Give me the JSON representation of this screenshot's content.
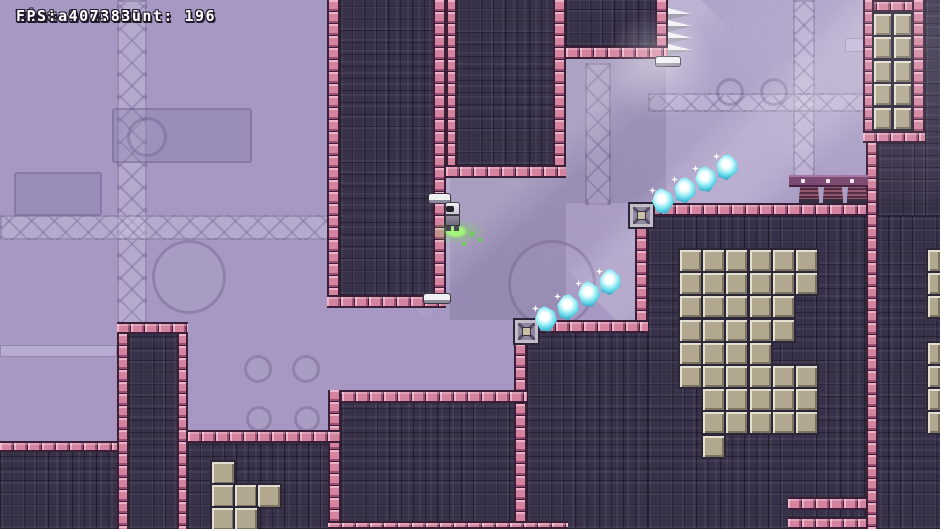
{
  "hud": {
    "lines": [
      "Time 0:16.19",
      "Best 0:13.72",
      "Instance count: 196",
      "FPS: 407.83"
    ]
  },
  "colors": {
    "bg": "#a698c2",
    "dark": "#38314a",
    "pink": "#d4849f",
    "pinkLight": "#eeb3c9",
    "pinkDark": "#9c4f72",
    "tan": "#b2a78f",
    "tanLight": "#e3dfd0",
    "tanDark": "#7b7261",
    "gem": "#6adcec",
    "green": "#5fd944",
    "beam": "#7a4870"
  },
  "level": {
    "decor": [
      {
        "t": "truss",
        "x": 117,
        "y": 0,
        "w": 30,
        "h": 325
      },
      {
        "t": "truss",
        "x": 793,
        "y": 0,
        "w": 22,
        "h": 178
      },
      {
        "t": "truss",
        "x": 0,
        "y": 215,
        "w": 335,
        "h": 25
      },
      {
        "t": "truss",
        "x": 648,
        "y": 93,
        "w": 222,
        "h": 19
      },
      {
        "t": "truss",
        "x": 585,
        "y": 63,
        "w": 26,
        "h": 142
      },
      {
        "t": "shade",
        "x": 450,
        "y": 178,
        "w": 116,
        "h": 142
      },
      {
        "t": "shade",
        "x": 566,
        "y": 59,
        "w": 100,
        "h": 144
      },
      {
        "t": "panel",
        "x": 14,
        "y": 172,
        "w": 88,
        "h": 44
      },
      {
        "t": "panel",
        "x": 112,
        "y": 108,
        "w": 140,
        "h": 55
      },
      {
        "t": "panel",
        "x": 258,
        "y": 448,
        "w": 72,
        "h": 81
      },
      {
        "t": "circle",
        "x": 127,
        "y": 117,
        "w": 40,
        "h": 40
      },
      {
        "t": "circle",
        "x": 152,
        "y": 240,
        "w": 74,
        "h": 74
      },
      {
        "t": "circle",
        "x": 244,
        "y": 355,
        "w": 28,
        "h": 28
      },
      {
        "t": "circle",
        "x": 292,
        "y": 355,
        "w": 28,
        "h": 28
      },
      {
        "t": "circle",
        "x": 246,
        "y": 406,
        "w": 26,
        "h": 26
      },
      {
        "t": "circle",
        "x": 294,
        "y": 406,
        "w": 26,
        "h": 26
      },
      {
        "t": "circle",
        "x": 716,
        "y": 78,
        "w": 28,
        "h": 28
      },
      {
        "t": "circle",
        "x": 760,
        "y": 78,
        "w": 28,
        "h": 28
      },
      {
        "t": "circle",
        "x": 508,
        "y": 240,
        "w": 88,
        "h": 88
      },
      {
        "t": "pipe",
        "x": 845,
        "y": 38,
        "w": 21,
        "h": 14
      },
      {
        "t": "pipe",
        "x": 0,
        "y": 345,
        "w": 117,
        "h": 12
      },
      {
        "t": "ray",
        "x": 470,
        "y": -80,
        "w": 130,
        "h": 420,
        "r": 46
      },
      {
        "t": "ray",
        "x": 700,
        "y": -60,
        "w": 110,
        "h": 430,
        "r": 46
      }
    ],
    "fills": [
      {
        "name": "column-a",
        "x": 340,
        "y": 0,
        "w": 93,
        "h": 295
      },
      {
        "name": "column-b",
        "x": 457,
        "y": 0,
        "w": 96,
        "h": 165
      },
      {
        "name": "column-c",
        "x": 566,
        "y": 0,
        "w": 89,
        "h": 46
      },
      {
        "name": "right-wall-top",
        "x": 925,
        "y": 0,
        "w": 15,
        "h": 216
      },
      {
        "name": "under-frame",
        "x": 878,
        "y": 143,
        "w": 47,
        "h": 73
      },
      {
        "name": "right-mass",
        "x": 648,
        "y": 216,
        "w": 292,
        "h": 313
      },
      {
        "name": "mid-step",
        "x": 527,
        "y": 333,
        "w": 121,
        "h": 196
      },
      {
        "name": "bottom-middle",
        "x": 341,
        "y": 403,
        "w": 173,
        "h": 126
      },
      {
        "name": "bottom-strip-right",
        "x": 188,
        "y": 443,
        "w": 152,
        "h": 86
      },
      {
        "name": "bottom-strip-left",
        "x": 0,
        "y": 452,
        "w": 117,
        "h": 77
      },
      {
        "name": "column-d",
        "x": 129,
        "y": 334,
        "w": 48,
        "h": 195
      }
    ],
    "pink_bars": [
      {
        "x": 327,
        "y": 0,
        "w": 13,
        "h": 308,
        "dir": "v"
      },
      {
        "x": 433,
        "y": 0,
        "w": 13,
        "h": 295,
        "dir": "v"
      },
      {
        "x": 327,
        "y": 295,
        "w": 119,
        "h": 13,
        "dir": "h"
      },
      {
        "x": 446,
        "y": 0,
        "w": 11,
        "h": 165,
        "dir": "v"
      },
      {
        "x": 553,
        "y": 0,
        "w": 13,
        "h": 165,
        "dir": "v"
      },
      {
        "x": 446,
        "y": 165,
        "w": 120,
        "h": 13,
        "dir": "h"
      },
      {
        "x": 655,
        "y": 0,
        "w": 13,
        "h": 46,
        "dir": "v"
      },
      {
        "x": 566,
        "y": 46,
        "w": 102,
        "h": 13,
        "dir": "h"
      },
      {
        "x": 648,
        "y": 203,
        "w": 219,
        "h": 13,
        "dir": "h"
      },
      {
        "x": 635,
        "y": 203,
        "w": 13,
        "h": 130,
        "dir": "v"
      },
      {
        "x": 514,
        "y": 320,
        "w": 134,
        "h": 13,
        "dir": "h"
      },
      {
        "x": 514,
        "y": 320,
        "w": 13,
        "h": 209,
        "dir": "v"
      },
      {
        "x": 328,
        "y": 390,
        "w": 199,
        "h": 13,
        "dir": "h"
      },
      {
        "x": 328,
        "y": 390,
        "w": 13,
        "h": 139,
        "dir": "v"
      },
      {
        "x": 328,
        "y": 521,
        "w": 240,
        "h": 8,
        "dir": "h"
      },
      {
        "x": 188,
        "y": 430,
        "w": 152,
        "h": 13,
        "dir": "h"
      },
      {
        "x": 0,
        "y": 441,
        "w": 117,
        "h": 11,
        "dir": "h"
      },
      {
        "x": 117,
        "y": 322,
        "w": 12,
        "h": 207,
        "dir": "v"
      },
      {
        "x": 177,
        "y": 322,
        "w": 11,
        "h": 207,
        "dir": "v"
      },
      {
        "x": 117,
        "y": 322,
        "w": 71,
        "h": 12,
        "dir": "h"
      },
      {
        "x": 866,
        "y": 143,
        "w": 12,
        "h": 386,
        "dir": "v"
      },
      {
        "x": 788,
        "y": 497,
        "w": 78,
        "h": 13,
        "dir": "h"
      },
      {
        "x": 788,
        "y": 517,
        "w": 78,
        "h": 12,
        "dir": "h"
      },
      {
        "x": 863,
        "y": 0,
        "w": 62,
        "h": 12,
        "dir": "h"
      },
      {
        "x": 863,
        "y": 0,
        "w": 11,
        "h": 143,
        "dir": "v"
      },
      {
        "x": 912,
        "y": 0,
        "w": 13,
        "h": 143,
        "dir": "v"
      },
      {
        "x": 863,
        "y": 131,
        "w": 62,
        "h": 12,
        "dir": "h"
      }
    ],
    "tan_pattern": {
      "x0": 680,
      "y0": 250,
      "step": 23.2,
      "tile": 21,
      "rows": [
        "111111",
        "111111",
        "111110",
        "111110",
        "111100",
        "111111",
        "011111",
        "011111",
        "010000"
      ]
    },
    "tan_frame": {
      "x0": 874,
      "y0": 14,
      "cols": 2,
      "rows": 5,
      "stepx": 19.5,
      "stepy": 23.4,
      "tw": 17,
      "th": 21
    },
    "right_edge_tiles": {
      "x": 928,
      "w": 12,
      "h": 21,
      "ys": [
        250,
        273,
        296,
        343,
        366,
        389,
        412
      ]
    },
    "tan_tiles_bottom": [
      [
        212,
        462
      ],
      [
        212,
        485
      ],
      [
        235,
        485
      ],
      [
        258,
        485
      ],
      [
        212,
        508
      ],
      [
        235,
        508
      ]
    ],
    "gems": [
      {
        "x": 546,
        "y": 319,
        "r": -8
      },
      {
        "x": 568,
        "y": 307,
        "r": 6
      },
      {
        "x": 589,
        "y": 294,
        "r": -5
      },
      {
        "x": 610,
        "y": 282,
        "r": 8
      },
      {
        "x": 663,
        "y": 201,
        "r": -8
      },
      {
        "x": 685,
        "y": 190,
        "r": 6
      },
      {
        "x": 706,
        "y": 179,
        "r": -5
      },
      {
        "x": 727,
        "y": 167,
        "r": 8
      }
    ],
    "boxes": [
      {
        "x": 515,
        "y": 320
      },
      {
        "x": 630,
        "y": 204
      }
    ],
    "spikes": {
      "x": 668,
      "y": 8,
      "count": 4,
      "w": 24,
      "h": 12
    },
    "springs": {
      "xs": [
        799,
        823,
        847
      ],
      "y": 186,
      "w": 20,
      "h": 17,
      "beam": {
        "x": 789,
        "y": 175,
        "w": 79,
        "h": 12,
        "dots": [
          12,
          37,
          61
        ]
      }
    },
    "ledges": [
      {
        "x": 429,
        "y": 194,
        "w": 21,
        "h": 9
      },
      {
        "x": 424,
        "y": 294,
        "w": 26,
        "h": 9
      },
      {
        "x": 656,
        "y": 57,
        "w": 24,
        "h": 9
      }
    ],
    "player": {
      "x": 443,
      "y": 202,
      "w": 20,
      "h": 30
    },
    "green_puff": {
      "x": 430,
      "y": 219,
      "w": 56,
      "h": 26,
      "core": {
        "x": 446,
        "y": 226,
        "w": 20,
        "h": 11
      },
      "dots": [
        [
          470,
          232
        ],
        [
          478,
          238
        ],
        [
          462,
          242
        ]
      ]
    },
    "glows": [
      {
        "x": 600,
        "y": 10,
        "w": 120,
        "h": 110
      },
      {
        "x": 700,
        "y": -120,
        "w": 420,
        "h": 320,
        "top": true
      }
    ]
  }
}
